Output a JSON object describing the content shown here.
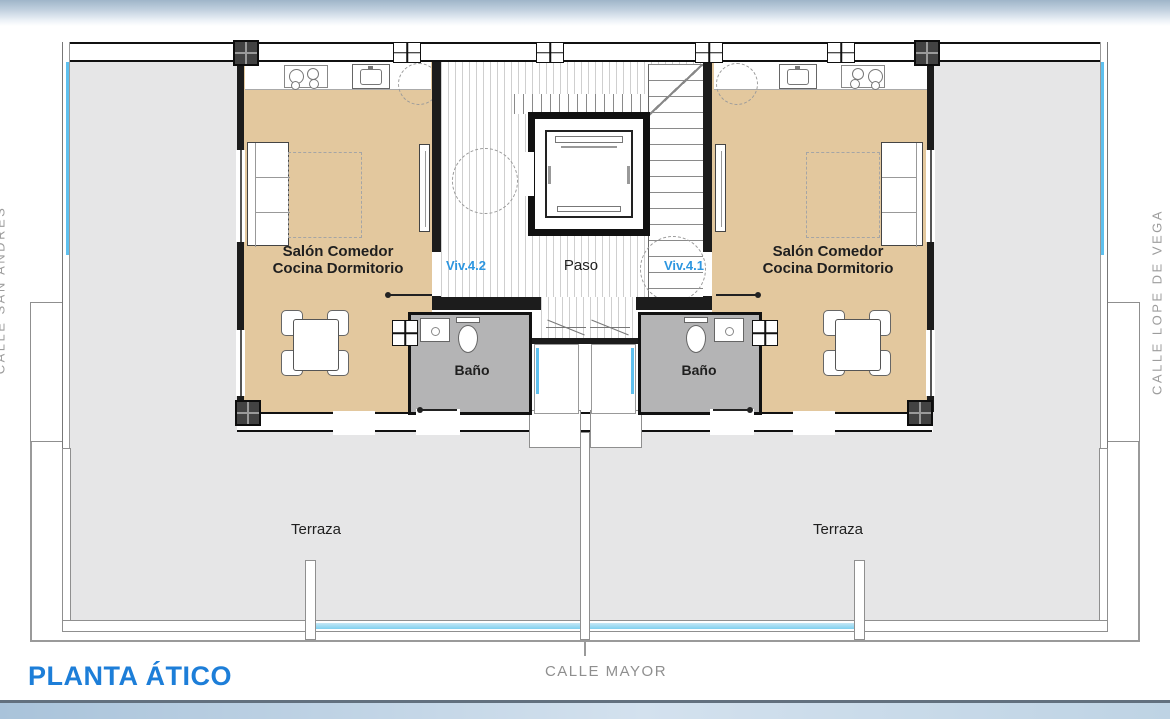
{
  "plan": {
    "title": "PLANTA ÁTICO",
    "hall_label": "Paso",
    "streets": {
      "bottom": "CALLE MAYOR",
      "right": "CALLE LOPE DE VEGA",
      "left": "CALLE SAN ANDRÉS"
    },
    "units": [
      {
        "id": "Viv.4.2",
        "room_line1": "Salón Comedor",
        "room_line2": "Cocina Dormitorio",
        "bath_label": "Baño",
        "terrace_label": "Terraza"
      },
      {
        "id": "Viv.4.1",
        "room_line1": "Salón Comedor",
        "room_line2": "Cocina Dormitorio",
        "bath_label": "Baño",
        "terrace_label": "Terraza"
      }
    ],
    "colors": {
      "unit_floor": "#e3c89e",
      "bath_floor": "#b4b4b5",
      "terrace_floor": "#e6e6e7",
      "glass_blue": "#5ec0ee",
      "label_blue": "#2d96e0",
      "title_blue": "#1d7ed8",
      "street_gray": "#8f8f8f",
      "wall_black": "#1c1c1c"
    }
  }
}
